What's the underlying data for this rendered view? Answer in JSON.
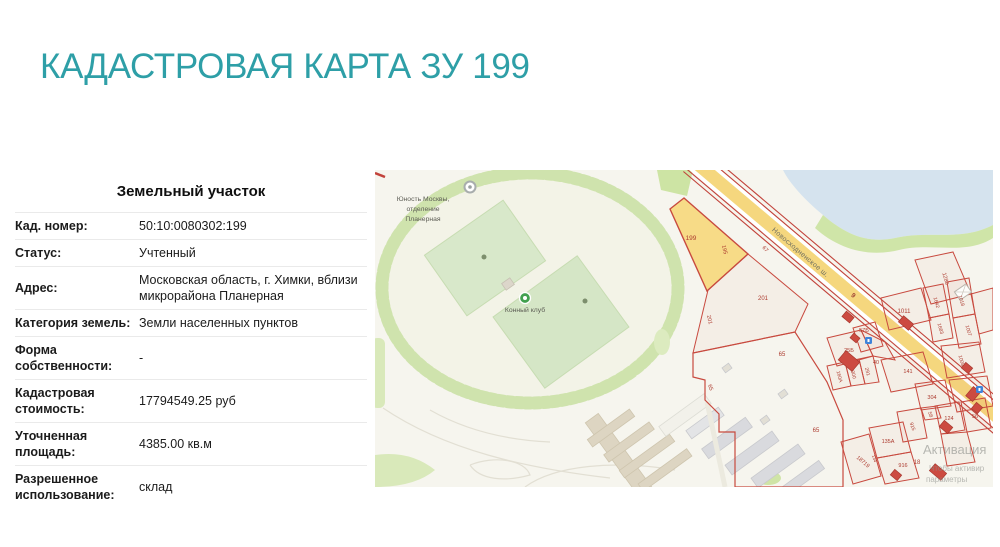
{
  "page": {
    "title": "КАДАСТРОВАЯ КАРТА ЗУ 199",
    "accent_color": "#2E9FA7"
  },
  "parcel_card": {
    "heading": "Земельный участок",
    "rows": [
      {
        "label": "Кад. номер:",
        "value": "50:10:0080302:199"
      },
      {
        "label": "Статус:",
        "value": "Учтенный"
      },
      {
        "label": "Адрес:",
        "value": "Московская область, г. Химки, вблизи микрорайона Планерная"
      },
      {
        "label": "Категория земель:",
        "value": "Земли населенных пунктов"
      },
      {
        "label": "Форма собственности:",
        "value": "-"
      },
      {
        "label": "Кадастровая стоимость:",
        "value": "17794549.25 руб"
      },
      {
        "label": "Уточненная площадь:",
        "value": "4385.00 кв.м"
      },
      {
        "label": "Разрешенное использование:",
        "value": "склад"
      }
    ]
  },
  "map": {
    "poi": {
      "sports_school_line1": "Юность Москвы,",
      "sports_school_line2": "отделение",
      "sports_school_line3": "Планерная",
      "horse_club": "Конный клуб"
    },
    "road": {
      "name": "Новосходненское ш.",
      "number": "9"
    },
    "highlight_fill": "#f7db87",
    "parcel_numbers": {
      "n199": "199",
      "n195": "195",
      "n67": "67",
      "n201a": "201",
      "n201b": "201",
      "n65a": "65",
      "n65b": "65",
      "n65c": "65",
      "n160a": "160А",
      "n300": "300",
      "n291": "291",
      "n40": "40",
      "n25b": "25Б",
      "n141": "141",
      "n57b": "57Б",
      "n1011": "1011",
      "n1642": "1642",
      "n1683": "1683",
      "n1018": "1018",
      "n1007": "1007",
      "n1008": "1008",
      "n1286": "1286",
      "n304": "304",
      "n58": "58",
      "n124": "124",
      "n915": "915",
      "n56": "56",
      "n135a": "135А",
      "n916": "916",
      "n18": "18",
      "n18719": "18719",
      "n134": "134"
    },
    "watermark": {
      "line1": "Активация",
      "line2": "Чтобы активир",
      "line3": "параметры"
    }
  }
}
